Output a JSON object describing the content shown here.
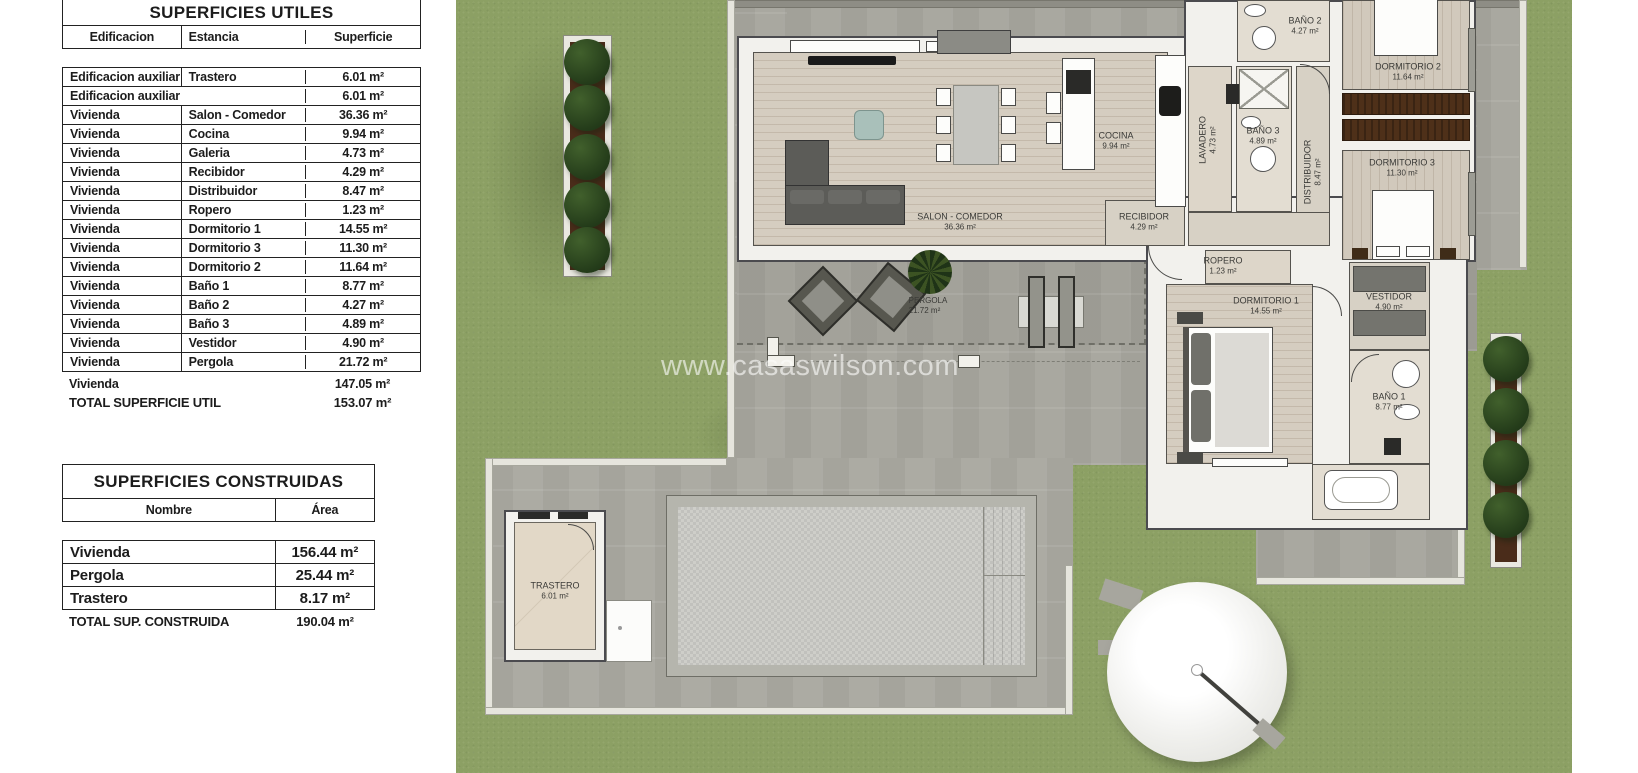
{
  "tables": {
    "utiles": {
      "title": "SUPERFICIES UTILES",
      "headers": {
        "edificacion": "Edificacion",
        "estancia": "Estancia",
        "superficie": "Superficie"
      },
      "rows": [
        {
          "edificacion": "Edificacion auxiliar",
          "estancia": "Trastero",
          "superficie": "6.01 m²"
        },
        {
          "edificacion": "Edificacion auxiliar",
          "estancia": "",
          "superficie": "6.01 m²"
        },
        {
          "edificacion": "Vivienda",
          "estancia": "Salon - Comedor",
          "superficie": "36.36 m²"
        },
        {
          "edificacion": "Vivienda",
          "estancia": "Cocina",
          "superficie": "9.94 m²"
        },
        {
          "edificacion": "Vivienda",
          "estancia": "Galeria",
          "superficie": "4.73 m²"
        },
        {
          "edificacion": "Vivienda",
          "estancia": "Recibidor",
          "superficie": "4.29 m²"
        },
        {
          "edificacion": "Vivienda",
          "estancia": "Distribuidor",
          "superficie": "8.47 m²"
        },
        {
          "edificacion": "Vivienda",
          "estancia": "Ropero",
          "superficie": "1.23 m²"
        },
        {
          "edificacion": "Vivienda",
          "estancia": "Dormitorio 1",
          "superficie": "14.55 m²"
        },
        {
          "edificacion": "Vivienda",
          "estancia": "Dormitorio 3",
          "superficie": "11.30 m²"
        },
        {
          "edificacion": "Vivienda",
          "estancia": "Dormitorio 2",
          "superficie": "11.64 m²"
        },
        {
          "edificacion": "Vivienda",
          "estancia": "Baño 1",
          "superficie": "8.77 m²"
        },
        {
          "edificacion": "Vivienda",
          "estancia": "Baño 2",
          "superficie": "4.27 m²"
        },
        {
          "edificacion": "Vivienda",
          "estancia": "Baño 3",
          "superficie": "4.89 m²"
        },
        {
          "edificacion": "Vivienda",
          "estancia": "Vestidor",
          "superficie": "4.90 m²"
        },
        {
          "edificacion": "Vivienda",
          "estancia": "Pergola",
          "superficie": "21.72 m²"
        }
      ],
      "subtotal": {
        "label": "Vivienda",
        "value": "147.05 m²"
      },
      "total": {
        "label": "TOTAL SUPERFICIE UTIL",
        "value": "153.07 m²"
      }
    },
    "construidas": {
      "title": "SUPERFICIES CONSTRUIDAS",
      "headers": {
        "nombre": "Nombre",
        "area": "Área"
      },
      "rows": [
        {
          "nombre": "Vivienda",
          "area": "156.44 m²"
        },
        {
          "nombre": "Pergola",
          "area": "25.44 m²"
        },
        {
          "nombre": "Trastero",
          "area": "8.17 m²"
        }
      ],
      "total": {
        "label": "TOTAL SUP. CONSTRUIDA",
        "value": "190.04 m²"
      }
    }
  },
  "plan": {
    "watermark": "www.casaswilson.com",
    "rooms": [
      {
        "name": "SALON - COMEDOR",
        "area": "36.36 m²"
      },
      {
        "name": "COCINA",
        "area": "9.94 m²"
      },
      {
        "name": "RECIBIDOR",
        "area": "4.29 m²"
      },
      {
        "name": "LAVADERO",
        "area": "4.73 m²"
      },
      {
        "name": "BAÑO 3",
        "area": "4.89 m²"
      },
      {
        "name": "BAÑO 2",
        "area": "4.27 m²"
      },
      {
        "name": "DISTRIBUIDOR",
        "area": "8.47 m²"
      },
      {
        "name": "DORMITORIO 2",
        "area": "11.64 m²"
      },
      {
        "name": "DORMITORIO 3",
        "area": "11.30 m²"
      },
      {
        "name": "ROPERO",
        "area": "1.23 m²"
      },
      {
        "name": "DORMITORIO 1",
        "area": "14.55 m²"
      },
      {
        "name": "VESTIDOR",
        "area": "4.90 m²"
      },
      {
        "name": "BAÑO 1",
        "area": "8.77 m²"
      },
      {
        "name": "PERGOLA",
        "area": "21.72 m²"
      },
      {
        "name": "TRASTERO",
        "area": "6.01 m²"
      }
    ],
    "colors": {
      "grass": "#8ca064",
      "paving": "#a9a8a0",
      "wall": "#f2f1ed",
      "wood_floor": "#d5cdc0",
      "tree": "#2f4a26",
      "planter_soil": "#4a2c1a",
      "pool": "#c9c9c5",
      "furniture_dark": "#5c5c58",
      "wardrobe_brown": "#4e3019"
    }
  }
}
